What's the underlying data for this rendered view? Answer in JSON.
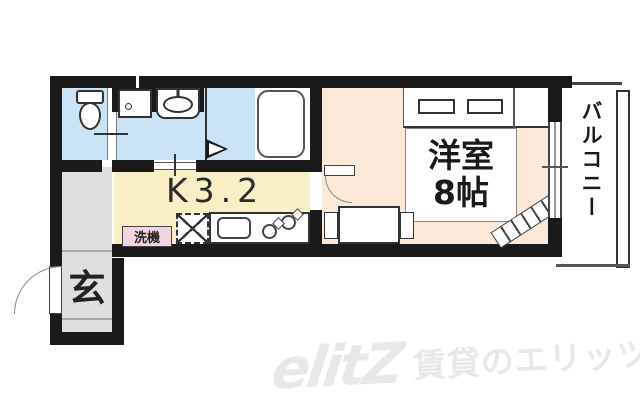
{
  "plan": {
    "kitchen_label": "K3.2",
    "room_label_1": "洋室",
    "room_label_2": "8帖",
    "balcony_label": "バルコニー",
    "entrance_label": "玄",
    "laundry_label": "洗機",
    "fixtures": [
      "toilet",
      "washing-machine-pan",
      "washbasin",
      "bathtub",
      "bath-folding-door",
      "kitchen-sink",
      "gas-stove-2-burner",
      "refrigerator-space",
      "dining-table",
      "chair",
      "loft-ladder",
      "closet",
      "entrance-door",
      "room-door",
      "balcony-window"
    ]
  },
  "watermark": {
    "logo": "elitZ",
    "text": "賃貸のエリッツ"
  },
  "colors": {
    "wall": "#1a1a1a",
    "wet_area": "#cae3f5",
    "kitchen": "#f9efc7",
    "room": "#fae9d9",
    "entrance": "#dfdfe1",
    "laundry_bg": "#f3d4e2",
    "watermark": "#e8e8ea"
  }
}
